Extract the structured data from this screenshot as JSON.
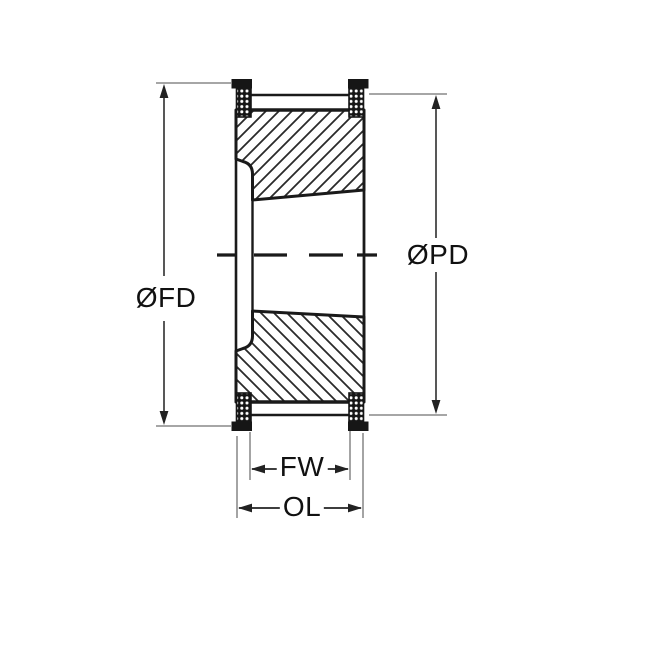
{
  "diagram": {
    "type": "timing-pulley-cross-section",
    "labels": {
      "flange_diameter": "ØFD",
      "pitch_diameter": "ØPD",
      "face_width": "FW",
      "overall_length": "OL"
    },
    "colors": {
      "outline": "#1a1a1a",
      "hatch": "#2a2a2a",
      "extension_line": "#9a9a9a",
      "dimension_line": "#3a3a3a",
      "background": "#ffffff"
    }
  }
}
